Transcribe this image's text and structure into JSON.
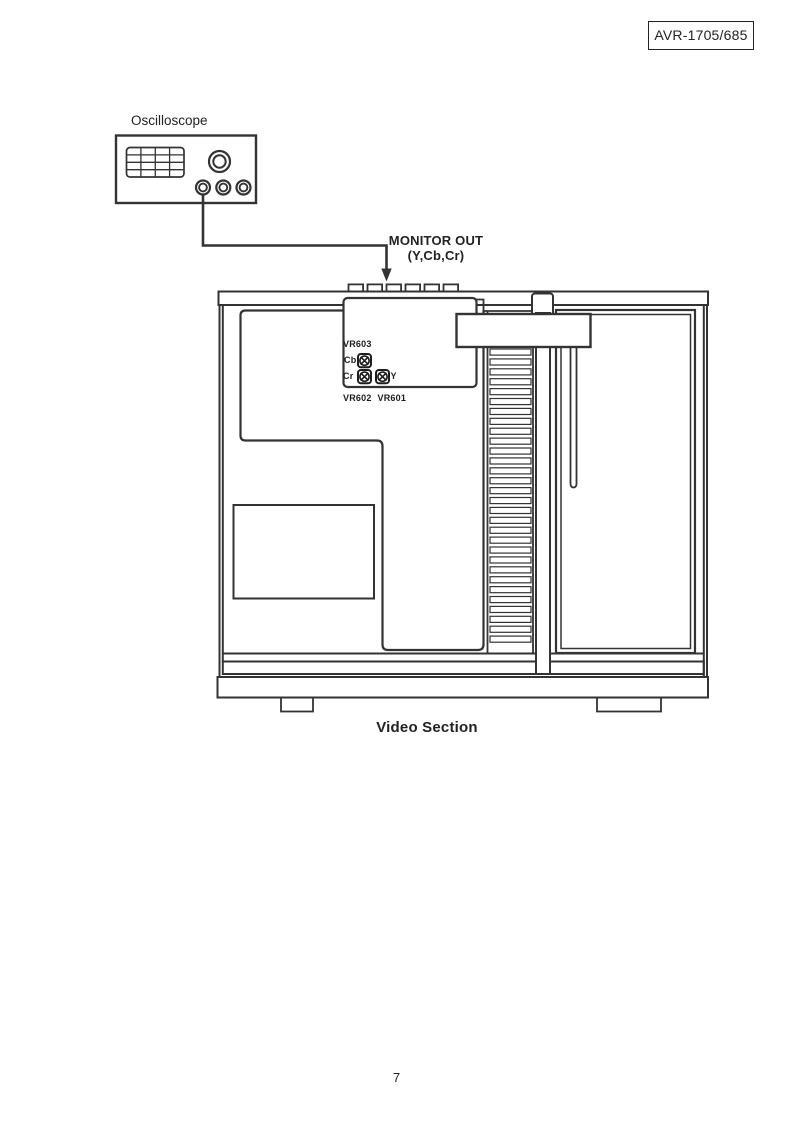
{
  "page": {
    "model": "AVR-1705/685",
    "caption": "Video Section",
    "page_number": "7"
  },
  "diagram": {
    "oscilloscope_label": "Oscilloscope",
    "monitor_out_label": "MONITOR OUT",
    "monitor_out_signals": "(Y,Cb,Cr)",
    "trimmers": {
      "vr603": "VR603",
      "vr602": "VR602",
      "vr601": "VR601",
      "cb": "Cb",
      "cr": "Cr",
      "y": "Y"
    }
  },
  "colors": {
    "line": "#333333",
    "text": "#222222",
    "background": "#ffffff"
  }
}
